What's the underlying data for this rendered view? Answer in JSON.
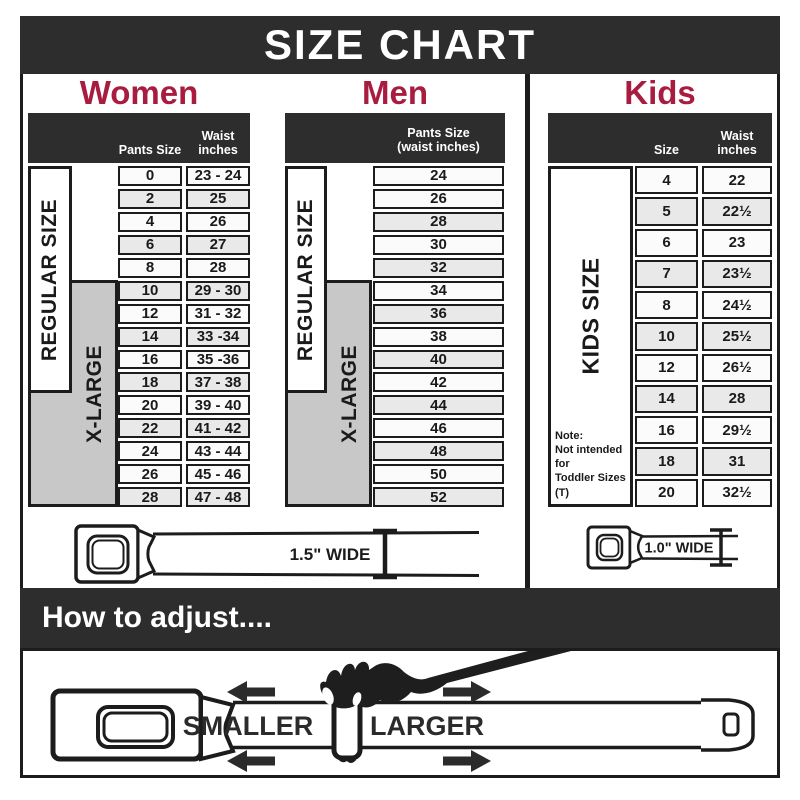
{
  "title": "SIZE CHART",
  "colors": {
    "dark": "#2d2d2d",
    "accent": "#a81c40",
    "border": "#1c1c1c",
    "row_shaded": "#e9e9e9",
    "label_gray": "#c8c8c8"
  },
  "sections": {
    "women": {
      "heading": "Women",
      "regular_label": "REGULAR SIZE",
      "xlarge_label": "X-LARGE",
      "col_size": "Pants Size",
      "col_waist": "Waist inches",
      "rows": [
        {
          "size": "0",
          "waist": "23 - 24",
          "shaded": false
        },
        {
          "size": "2",
          "waist": "25",
          "shaded": true
        },
        {
          "size": "4",
          "waist": "26",
          "shaded": false
        },
        {
          "size": "6",
          "waist": "27",
          "shaded": true
        },
        {
          "size": "8",
          "waist": "28",
          "shaded": false
        },
        {
          "size": "10",
          "waist": "29 - 30",
          "shaded": true
        },
        {
          "size": "12",
          "waist": "31 - 32",
          "shaded": false
        },
        {
          "size": "14",
          "waist": "33 -34",
          "shaded": true
        },
        {
          "size": "16",
          "waist": "35 -36",
          "shaded": false
        },
        {
          "size": "18",
          "waist": "37 - 38",
          "shaded": true
        },
        {
          "size": "20",
          "waist": "39 - 40",
          "shaded": false
        },
        {
          "size": "22",
          "waist": "41 - 42",
          "shaded": true
        },
        {
          "size": "24",
          "waist": "43 - 44",
          "shaded": false
        },
        {
          "size": "26",
          "waist": "45 - 46",
          "shaded": false
        },
        {
          "size": "28",
          "waist": "47 - 48",
          "shaded": true
        }
      ]
    },
    "men": {
      "heading": "Men",
      "regular_label": "REGULAR SIZE",
      "xlarge_label": "X-LARGE",
      "col_header_line1": "Pants Size",
      "col_header_line2": "(waist inches)",
      "rows": [
        {
          "size": "24",
          "shaded": false
        },
        {
          "size": "26",
          "shaded": false
        },
        {
          "size": "28",
          "shaded": true
        },
        {
          "size": "30",
          "shaded": false
        },
        {
          "size": "32",
          "shaded": true
        },
        {
          "size": "34",
          "shaded": false
        },
        {
          "size": "36",
          "shaded": true
        },
        {
          "size": "38",
          "shaded": false
        },
        {
          "size": "40",
          "shaded": true
        },
        {
          "size": "42",
          "shaded": false
        },
        {
          "size": "44",
          "shaded": true
        },
        {
          "size": "46",
          "shaded": false
        },
        {
          "size": "48",
          "shaded": true
        },
        {
          "size": "50",
          "shaded": false
        },
        {
          "size": "52",
          "shaded": true
        }
      ]
    },
    "kids": {
      "heading": "Kids",
      "side_label": "KIDS SIZE",
      "col_size": "Size",
      "col_waist": "Waist inches",
      "note_lines": [
        "Note:",
        "Not intended for",
        "Toddler Sizes (T)"
      ],
      "rows": [
        {
          "size": "4",
          "waist": "22",
          "shaded": false
        },
        {
          "size": "5",
          "waist": "22½",
          "shaded": true
        },
        {
          "size": "6",
          "waist": "23",
          "shaded": false
        },
        {
          "size": "7",
          "waist": "23½",
          "shaded": true
        },
        {
          "size": "8",
          "waist": "24½",
          "shaded": false
        },
        {
          "size": "10",
          "waist": "25½",
          "shaded": true
        },
        {
          "size": "12",
          "waist": "26½",
          "shaded": false
        },
        {
          "size": "14",
          "waist": "28",
          "shaded": true
        },
        {
          "size": "16",
          "waist": "29½",
          "shaded": false
        },
        {
          "size": "18",
          "waist": "31",
          "shaded": true
        },
        {
          "size": "20",
          "waist": "32½",
          "shaded": false
        }
      ]
    }
  },
  "belts": {
    "adult_label": "1.5\" WIDE",
    "kids_label": "1.0\" WIDE"
  },
  "adjust": {
    "heading": "How to adjust....",
    "smaller": "SMALLER",
    "larger": "LARGER"
  }
}
